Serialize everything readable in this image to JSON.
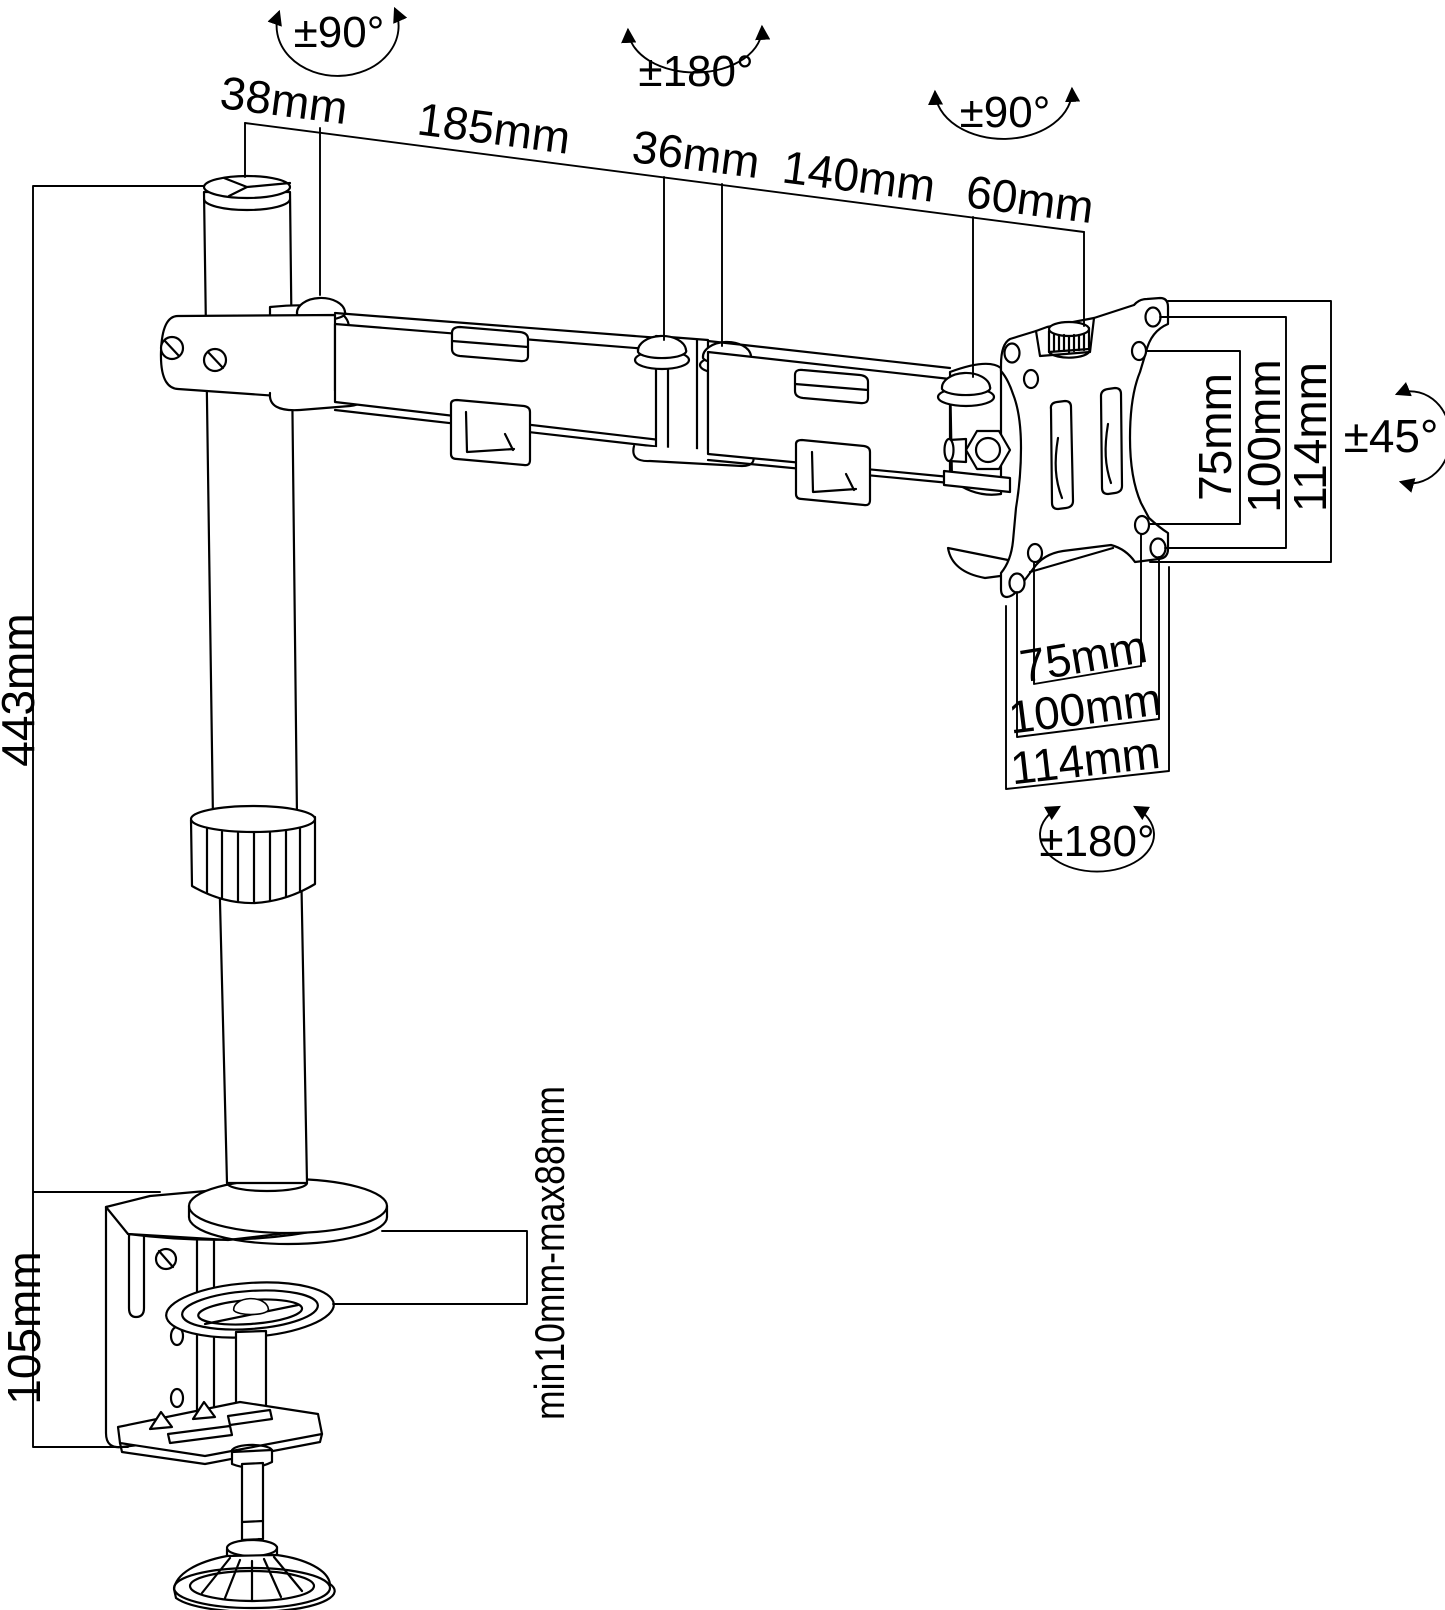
{
  "diagram": {
    "background": "#ffffff",
    "line_color": "#000000",
    "labels": {
      "rot_pole": "±90°",
      "rot_mid": "±180°",
      "rot_end": "±90°",
      "rot_tilt": "±45°",
      "rot_plate": "±180°",
      "cap_width": "38mm",
      "arm1_len": "185mm",
      "joint_width": "36mm",
      "arm2_len": "140mm",
      "end_offset": "60mm",
      "pole_height": "443mm",
      "clamp_height": "105mm",
      "desk_range": "min10mm-max88mm",
      "vesa_side_75": "75mm",
      "vesa_side_100": "100mm",
      "vesa_side_114": "114mm",
      "vesa_bottom_75": "75mm",
      "vesa_bottom_100": "100mm",
      "vesa_bottom_114": "114mm"
    }
  }
}
